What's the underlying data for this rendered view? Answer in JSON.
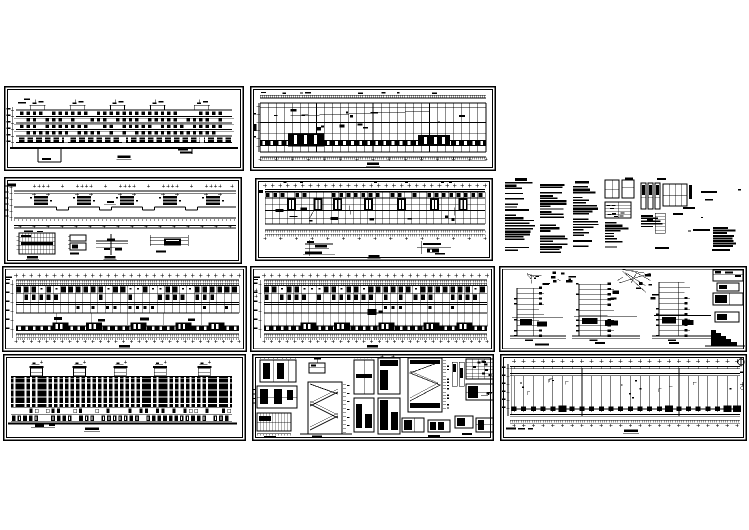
{
  "canvas": {
    "width": 749,
    "height": 530,
    "background": "#ffffff",
    "ink": "#000000"
  },
  "document_kind": "cad-architectural-drawing-set-preview",
  "panels": [
    {
      "id": "p1",
      "name": "front-elevation-sheet",
      "kind": "elevation-front",
      "x": 4,
      "y": 86,
      "w": 240,
      "h": 85,
      "seed": 11,
      "framed": true,
      "params": {
        "bulkheads": 5,
        "floors": 6
      }
    },
    {
      "id": "p2",
      "name": "upper-floor-plan-sheet",
      "kind": "plan-roof",
      "x": 250,
      "y": 86,
      "w": 246,
      "h": 85,
      "seed": 22,
      "framed": true,
      "params": {
        "bays": 28
      }
    },
    {
      "id": "p3",
      "name": "roof-plan-with-details-sheet",
      "kind": "roof-details",
      "x": 4,
      "y": 177,
      "w": 238,
      "h": 87,
      "seed": 33,
      "framed": true,
      "params": {
        "bulkheads": 5,
        "detail_drawings": 4
      }
    },
    {
      "id": "p4",
      "name": "floor-plan-sheet",
      "kind": "plan-rooms",
      "x": 255,
      "y": 178,
      "w": 238,
      "h": 83,
      "seed": 44,
      "framed": true,
      "params": {
        "bays": 30,
        "stair_cores": 7
      }
    },
    {
      "id": "nt",
      "name": "design-notes-text-block",
      "kind": "notes",
      "x": 505,
      "y": 177,
      "w": 242,
      "h": 88,
      "seed": 55,
      "framed": false,
      "params": {
        "text_columns": 3,
        "sketches": 5
      }
    },
    {
      "id": "p5",
      "name": "standard-floor-plan-sheet",
      "kind": "plan-standard",
      "x": 2,
      "y": 266,
      "w": 245,
      "h": 86,
      "seed": 66,
      "framed": true,
      "params": {
        "bays": 30,
        "dense": false
      }
    },
    {
      "id": "p6",
      "name": "second-floor-plan-sheet",
      "kind": "plan-standard",
      "x": 250,
      "y": 266,
      "w": 245,
      "h": 86,
      "seed": 77,
      "framed": true,
      "params": {
        "bays": 30,
        "dense": true
      }
    },
    {
      "id": "p7",
      "name": "stair-section-details-sheet",
      "kind": "stair-sections",
      "x": 499,
      "y": 266,
      "w": 248,
      "h": 86,
      "seed": 88,
      "framed": true,
      "params": {
        "sections": 3
      }
    },
    {
      "id": "p8",
      "name": "rear-elevation-sheet",
      "kind": "elevation-dense",
      "x": 3,
      "y": 354,
      "w": 243,
      "h": 87,
      "seed": 99,
      "framed": true,
      "params": {
        "bulkheads": 5
      }
    },
    {
      "id": "p9",
      "name": "stair-plan-details-sheet",
      "kind": "stair-details",
      "x": 252,
      "y": 354,
      "w": 242,
      "h": 87,
      "seed": 111,
      "framed": true,
      "params": {
        "details": 12
      }
    },
    {
      "id": "p10",
      "name": "long-roof-plan-sheet",
      "kind": "roof-plan-long",
      "x": 500,
      "y": 354,
      "w": 247,
      "h": 87,
      "seed": 122,
      "framed": true,
      "params": {
        "bays": 24
      }
    }
  ]
}
